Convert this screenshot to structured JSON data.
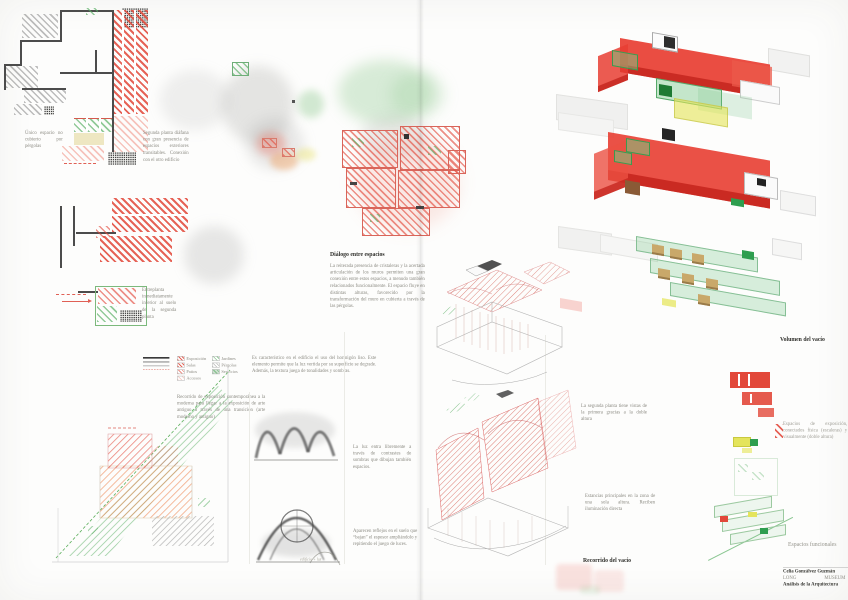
{
  "captions": {
    "unico": "Único espacio no cubierto por pérgolas",
    "segunda": "Segunda planta diáfana con gran presencia de espacios exteriores transitables. Conexión con el otro edificio",
    "entreplanta": "Entreplanta inmediatamente inferior al suelo de la segunda planta",
    "recorrido_expo": "Recorrido de exposición contemporánea a la moderna para llegar a la exposición de arte antiguo a través de una transición (arte moderno y antiguo)",
    "hormigon": "Es característico en el edificio el uso del hormigón liso. Este elemento permite que la luz vertida por su superficie se degrade. Además, la textura juega de tonalidades y sombras.",
    "luz": "La luz entra libremente a través de contrastes de sombras que dibujan también espacios.",
    "reflejos": "Aparecen reflejos en el suelo que “bajan” el espesor ampliándolo y repitiendo el juego de luces.",
    "doble_altura": "La segunda planta tiene vistas de la primera gracias a la doble altura",
    "estancias": "Estancias principales en la zona de una sola altura. Reciben iluminación directa",
    "exposicion": "Espacios de exposición, conectados física (escaleras) y visualmente (doble altura)"
  },
  "dialogue": {
    "heading": "Diálogo entre espacios",
    "body": "La reiterada presencia de cristaleras y la acertada articulación de los muros permiten una gran conexión entre estos espacios, a menudo también relacionados funcionalmente. El espacio fluye en distintas alturas, favorecido por la transformación del muro en cubierta a través de las pérgolas."
  },
  "labels": {
    "volumen_del_vacio": "Volumen del vacío",
    "recorrido_del_vacio": "Recorrido del vacío",
    "espacios_funcionales": "Espacios funcionales"
  },
  "legend": {
    "red": [
      "Exposición",
      "Salas",
      "Patios",
      "Accesos"
    ],
    "green": [
      "Jardines",
      "Pérgolas",
      "Servicios"
    ]
  },
  "credits": {
    "author": "Celia Gonzálvez Guzmán",
    "project_left": "LONG",
    "project_right": "MUSEUM",
    "course": "Análisis de la Arquitectura"
  },
  "notes": {
    "sketch_note": "edificio + luz"
  },
  "colors": {
    "red": "#e2483a",
    "green": "#57ae63",
    "yellow": "#e4e45c",
    "tan": "#c9a86a",
    "grey_hatch": "#b9b9b9",
    "ink": "#4c4c4c"
  }
}
